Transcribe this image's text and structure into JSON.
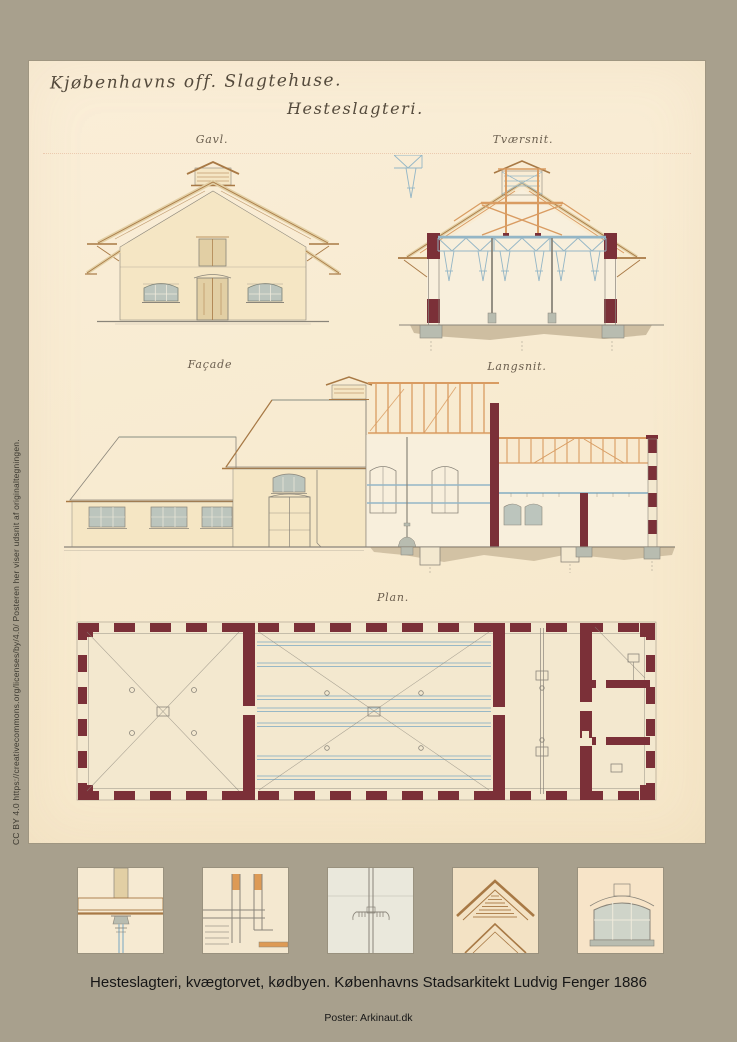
{
  "poster": {
    "caption": "Hesteslagteri, kvægtorvet, kødbyen. Københavns Stadsarkitekt Ludvig Fenger 1886",
    "credit": "Poster: Arkinaut.dk",
    "license_text": "CC BY 4.0  https://creativecommons.org/licenses/by/4.0/  Posteren her viser udsnit af originaltegningen."
  },
  "sheet": {
    "title_line1": "Kjøbenhavns off. Slagtehuse.",
    "title_line2": "Hesteslagteri.",
    "labels": {
      "gavl": "Gavl.",
      "tvaersnit": "Tværsnit.",
      "facade": "Façade",
      "langsnit": "Langsnit.",
      "plan": "Plan."
    }
  },
  "drawings": [
    {
      "name": "gavl-elevation",
      "label": "Gavl."
    },
    {
      "name": "cross-section",
      "label": "Tværsnit."
    },
    {
      "name": "facade-elevation",
      "label": "Façade"
    },
    {
      "name": "longitudinal-section",
      "label": "Langsnit."
    },
    {
      "name": "floor-plan",
      "label": "Plan."
    }
  ],
  "thumbnails": [
    {
      "name": "column-capital-detail"
    },
    {
      "name": "timber-joint-detail"
    },
    {
      "name": "rail-hanger-detail"
    },
    {
      "name": "gable-louver-detail"
    },
    {
      "name": "arched-window-detail"
    }
  ],
  "colors": {
    "poster_background": "#a8a08d",
    "sheet_cream": "#f8ebd1",
    "masonry_maroon": "#7b3038",
    "timber_orange": "#d99c62",
    "timber_dark": "#a87945",
    "steel_blue": "#94b6c6",
    "roof_grey": "#a6ac9f",
    "roof_line": "#878e83",
    "wall_cream": "#f5e6c4",
    "window_grey": "#bcc5bd",
    "line_grey": "#8a857a",
    "soil_brown": "#9c8767",
    "stone_grey": "#b8bcb0",
    "door_tan": "#e2cfa4",
    "floor_cream": "#f3e8cf",
    "title_ink": "#544a3c",
    "label_ink": "#6a5e4e",
    "caption_ink": "#161616"
  }
}
